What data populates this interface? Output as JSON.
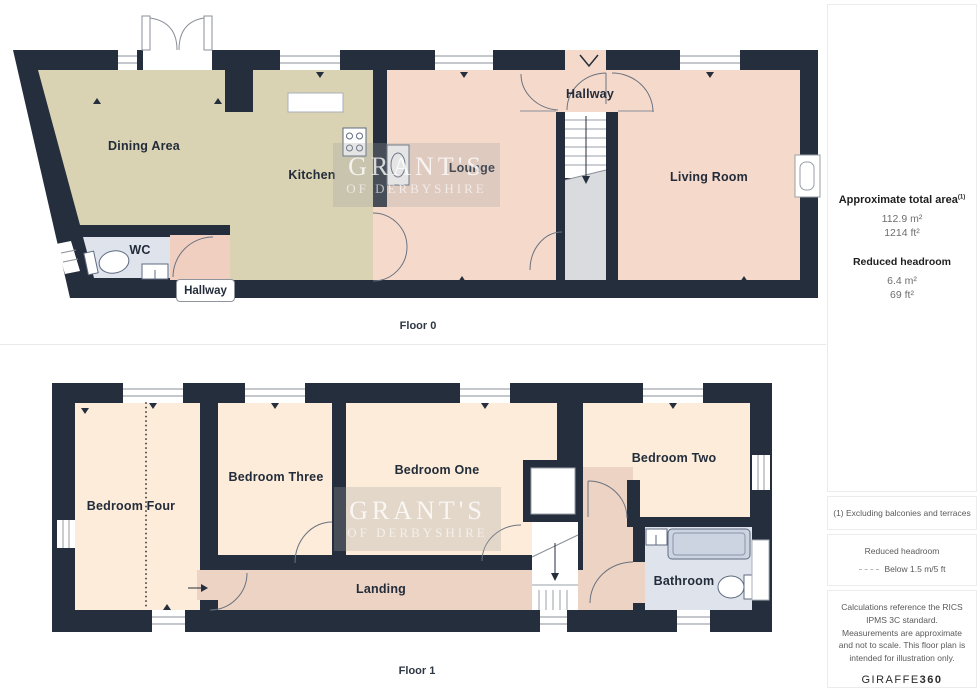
{
  "floor0": {
    "caption": "Floor 0",
    "rooms": {
      "dining": "Dining Area",
      "kitchen": "Kitchen",
      "lounge": "Lounge",
      "hallway_top": "Hallway",
      "living": "Living Room",
      "wc": "WC",
      "hallway_bottom": "Hallway"
    }
  },
  "floor1": {
    "caption": "Floor 1",
    "rooms": {
      "bed4": "Bedroom Four",
      "bed3": "Bedroom Three",
      "bed1": "Bedroom One",
      "bed2": "Bedroom Two",
      "landing": "Landing",
      "bathroom": "Bathroom"
    }
  },
  "watermark": {
    "line1": "GRANT'S",
    "line2": "OF DERBYSHIRE"
  },
  "sidebar": {
    "area_title": "Approximate total area",
    "area_sup": "(1)",
    "area_m2": "112.9 m²",
    "area_ft2": "1214 ft²",
    "headroom_title": "Reduced headroom",
    "headroom_m2": "6.4 m²",
    "headroom_ft2": "69 ft²",
    "note_excluding": "(1) Excluding balconies and terraces",
    "legend_title": "Reduced headroom",
    "legend_value": "Below 1.5 m/5 ft",
    "disclaimer": "Calculations reference the RICS IPMS 3C standard. Measurements are approximate and not to scale. This floor plan is intended for illustration only.",
    "brand_name": "GIRAFFE",
    "brand_number": "360"
  },
  "colors": {
    "wall": "#242e3c",
    "kitchen_dining": "#d9d2b3",
    "lounge_living": "#f5dacb",
    "entry_landing": "#ecd3c3",
    "bedroom_cream": "#fcecd9",
    "wet_room": "#dfe3ec",
    "stairs_gray": "#d9dbde"
  }
}
